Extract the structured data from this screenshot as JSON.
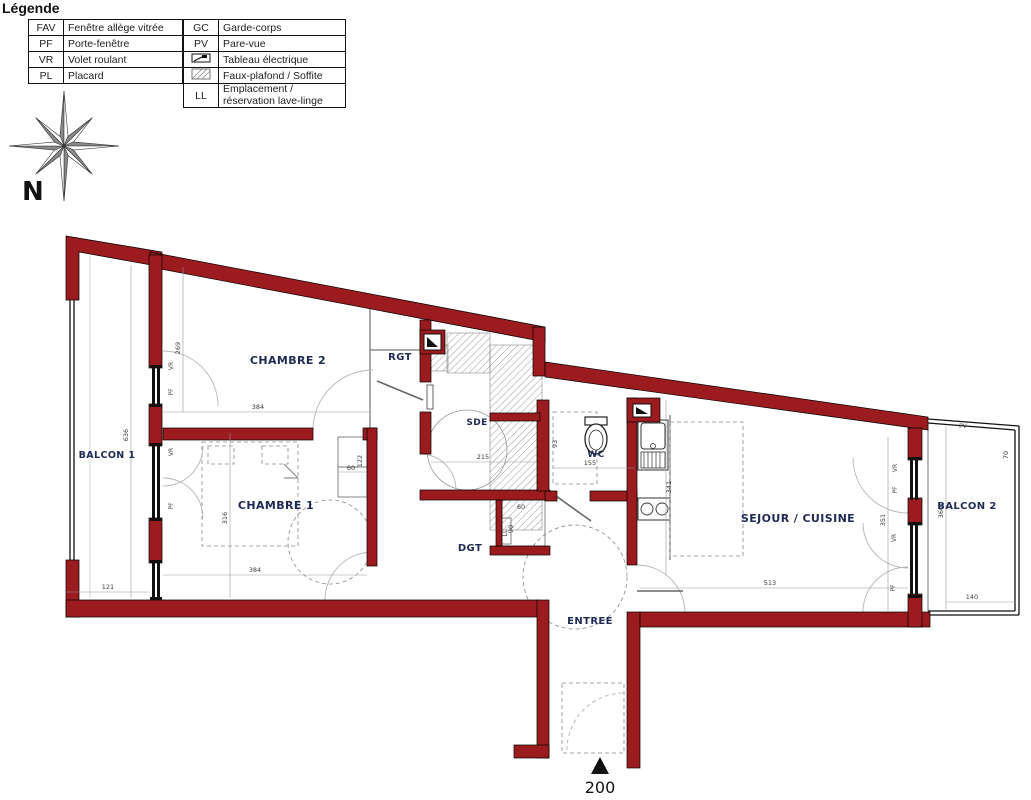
{
  "legend": {
    "title": "Légende",
    "left_rows": [
      {
        "code": "FAV",
        "label": "Fenêtre allège vitrée"
      },
      {
        "code": "PF",
        "label": "Porte-fenêtre"
      },
      {
        "code": "VR",
        "label": "Volet roulant"
      },
      {
        "code": "PL",
        "label": "Placard"
      }
    ],
    "right_rows": [
      {
        "code": "GC",
        "label": "Garde-corps"
      },
      {
        "code": "PV",
        "label": "Pare-vue"
      },
      {
        "icon": "electrical-panel-icon",
        "label": "Tableau électrique"
      },
      {
        "icon": "soffit-hatch-icon",
        "label": "Faux-plafond / Soffite"
      },
      {
        "code": "LL",
        "label": "Emplacement / réservation lave-linge"
      }
    ]
  },
  "compass": {
    "north": "N"
  },
  "plan": {
    "rooms": {
      "balcon1": "BALCON 1",
      "chambre2": "CHAMBRE 2",
      "chambre1": "CHAMBRE 1",
      "rgt": "RGT",
      "sde": "SDE",
      "wc": "WC",
      "dgt": "DGT",
      "sejour": "SEJOUR / CUISINE",
      "balcon2": "BALCON 2",
      "entree": "ENTREE"
    },
    "dims": {
      "chambre2_width": "384",
      "chambre1_width": "384",
      "balcon1_length": "636",
      "balcon1_width": "121",
      "chambre2_bay": "269",
      "chambre1_bay": "316",
      "sde_width": "215",
      "wc_width": "155",
      "wc_depth": "93",
      "closet_width": "60",
      "closet_height": "122",
      "ll_width": "60",
      "ll_depth": "90",
      "kitchen_length": "341",
      "sejour_width": "513",
      "sejour_bay": "351",
      "balcon2_width": "140",
      "balcon2_length": "360",
      "balcon2_side": "70",
      "entrance_mark": "200"
    },
    "labels": {
      "vr": "VR",
      "pf": "PF",
      "pv": "PV",
      "ll": "LL"
    }
  },
  "colors": {
    "wall": "#9b1b1e",
    "room_label": "#1e2a54",
    "dim": "#3a3a3a"
  }
}
